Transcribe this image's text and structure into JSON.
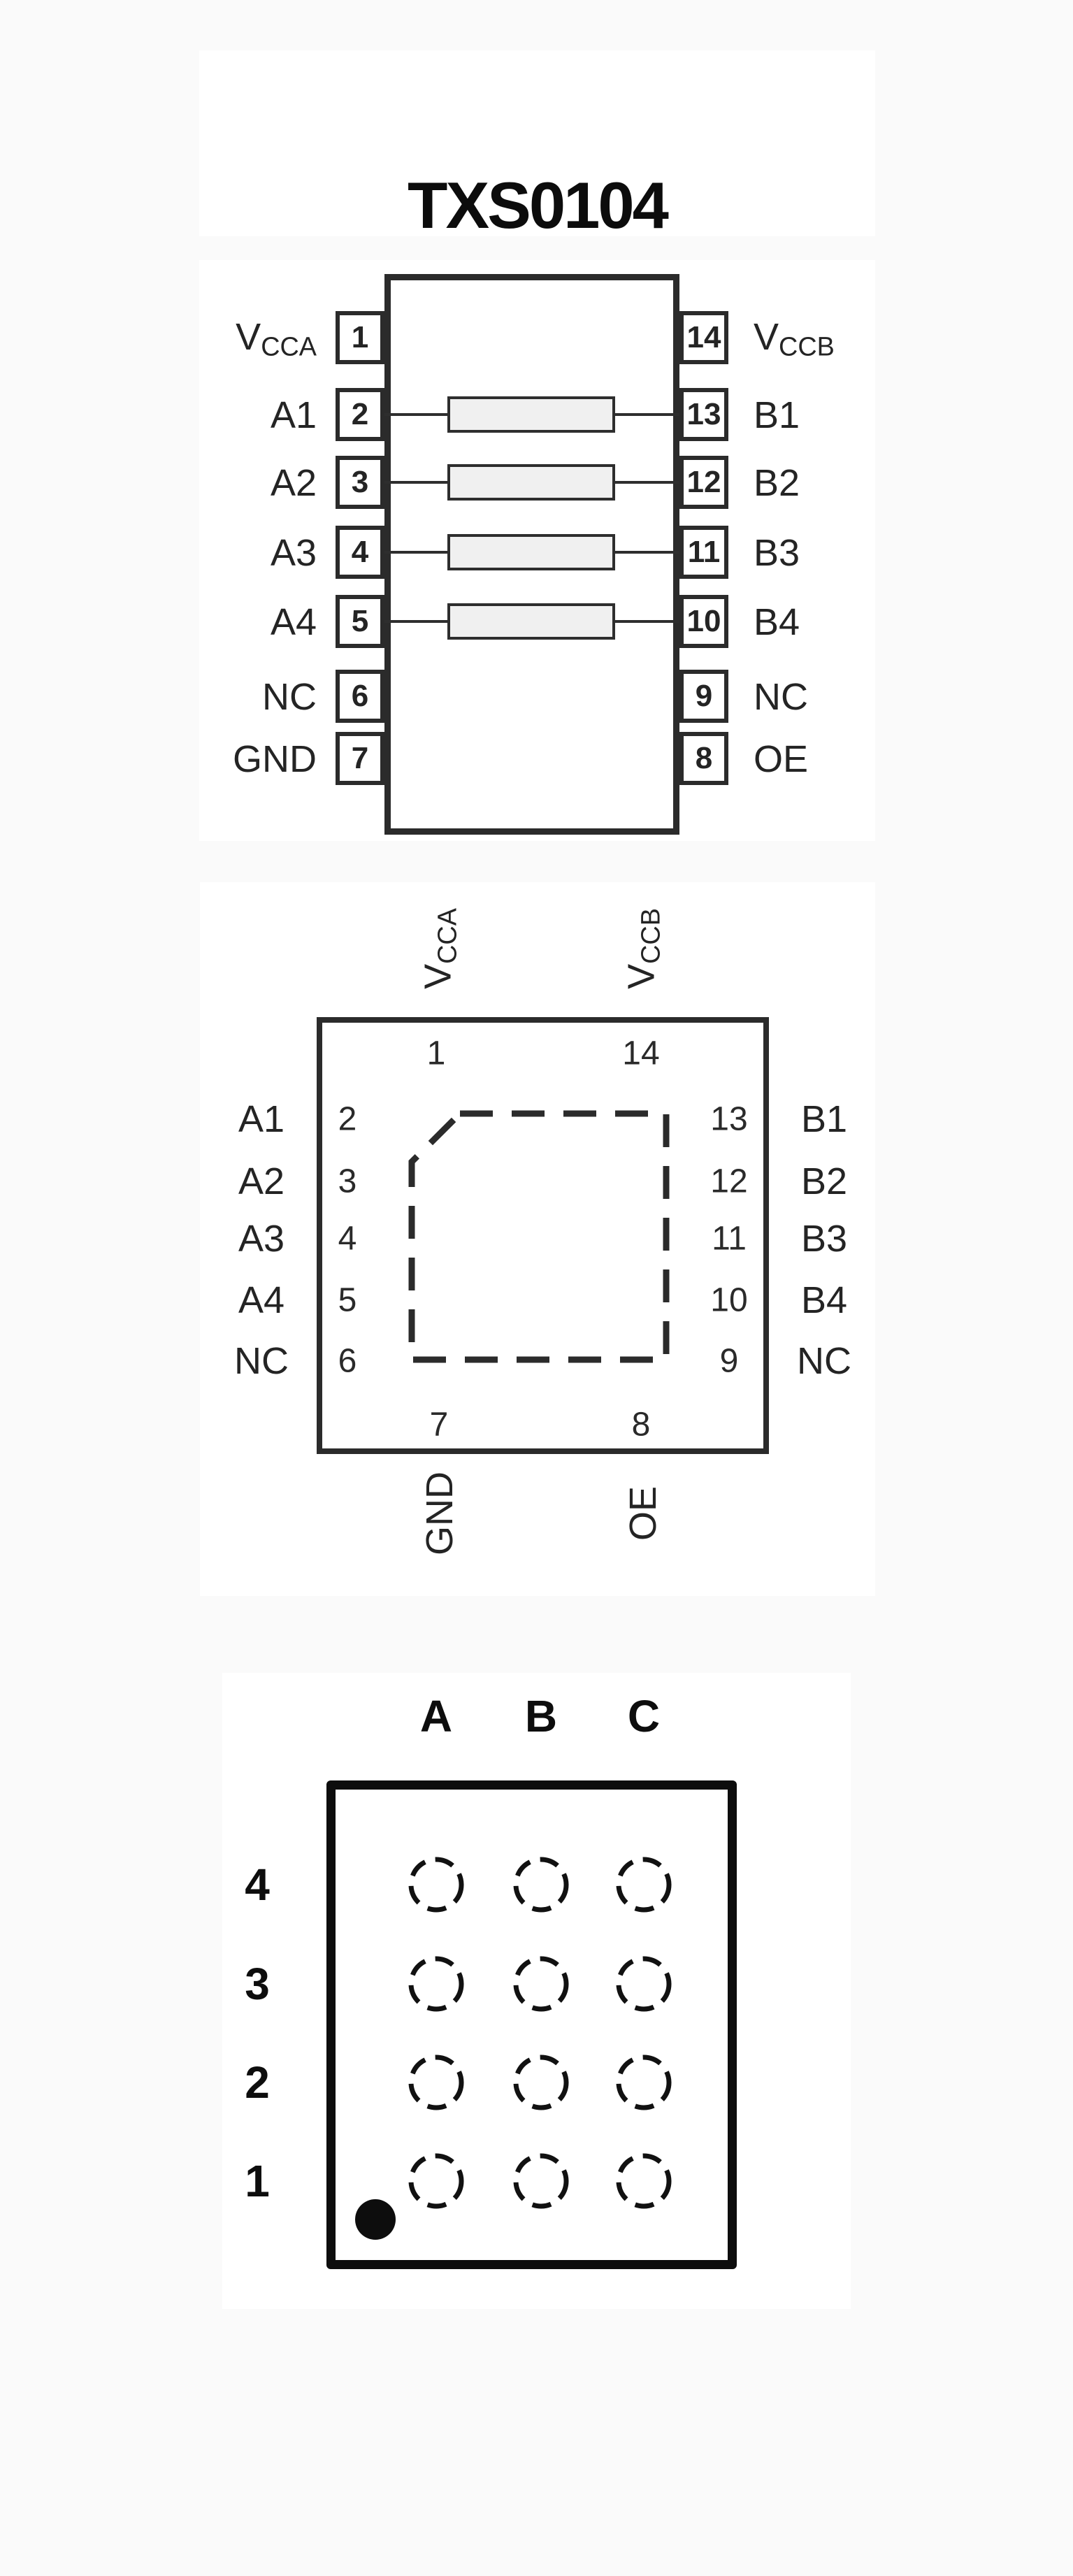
{
  "title": "TXS0104",
  "colors": {
    "page_background": "#fafafa",
    "panel_background": "#ffffff",
    "line": "#2b2b2b",
    "bga_line": "#0d0d0d",
    "resistor_fill": "#f0f0f0"
  },
  "dip": {
    "rows": [
      {
        "left_num": "1",
        "left_main": "V",
        "left_sub": "CCA",
        "right_num": "14",
        "right_main": "V",
        "right_sub": "CCB",
        "resistor": false
      },
      {
        "left_num": "2",
        "left_main": "A1",
        "left_sub": "",
        "right_num": "13",
        "right_main": "B1",
        "right_sub": "",
        "resistor": true
      },
      {
        "left_num": "3",
        "left_main": "A2",
        "left_sub": "",
        "right_num": "12",
        "right_main": "B2",
        "right_sub": "",
        "resistor": true
      },
      {
        "left_num": "4",
        "left_main": "A3",
        "left_sub": "",
        "right_num": "11",
        "right_main": "B3",
        "right_sub": "",
        "resistor": true
      },
      {
        "left_num": "5",
        "left_main": "A4",
        "left_sub": "",
        "right_num": "10",
        "right_main": "B4",
        "right_sub": "",
        "resistor": true
      },
      {
        "left_num": "6",
        "left_main": "NC",
        "left_sub": "",
        "right_num": "9",
        "right_main": "NC",
        "right_sub": "",
        "resistor": false
      },
      {
        "left_num": "7",
        "left_main": "GND",
        "left_sub": "",
        "right_num": "8",
        "right_main": "OE",
        "right_sub": "",
        "resistor": false
      }
    ]
  },
  "qfn": {
    "top": [
      {
        "num": "1",
        "main": "V",
        "sub": "CCA"
      },
      {
        "num": "14",
        "main": "V",
        "sub": "CCB"
      }
    ],
    "left": [
      {
        "num": "2",
        "label": "A1"
      },
      {
        "num": "3",
        "label": "A2"
      },
      {
        "num": "4",
        "label": "A3"
      },
      {
        "num": "5",
        "label": "A4"
      },
      {
        "num": "6",
        "label": "NC"
      }
    ],
    "right": [
      {
        "num": "13",
        "label": "B1"
      },
      {
        "num": "12",
        "label": "B2"
      },
      {
        "num": "11",
        "label": "B3"
      },
      {
        "num": "10",
        "label": "B4"
      },
      {
        "num": "9",
        "label": "NC"
      }
    ],
    "bottom": [
      {
        "num": "7",
        "label": "GND"
      },
      {
        "num": "8",
        "label": "OE"
      }
    ]
  },
  "bga": {
    "columns": [
      "A",
      "B",
      "C"
    ],
    "rows": [
      "4",
      "3",
      "2",
      "1"
    ]
  }
}
